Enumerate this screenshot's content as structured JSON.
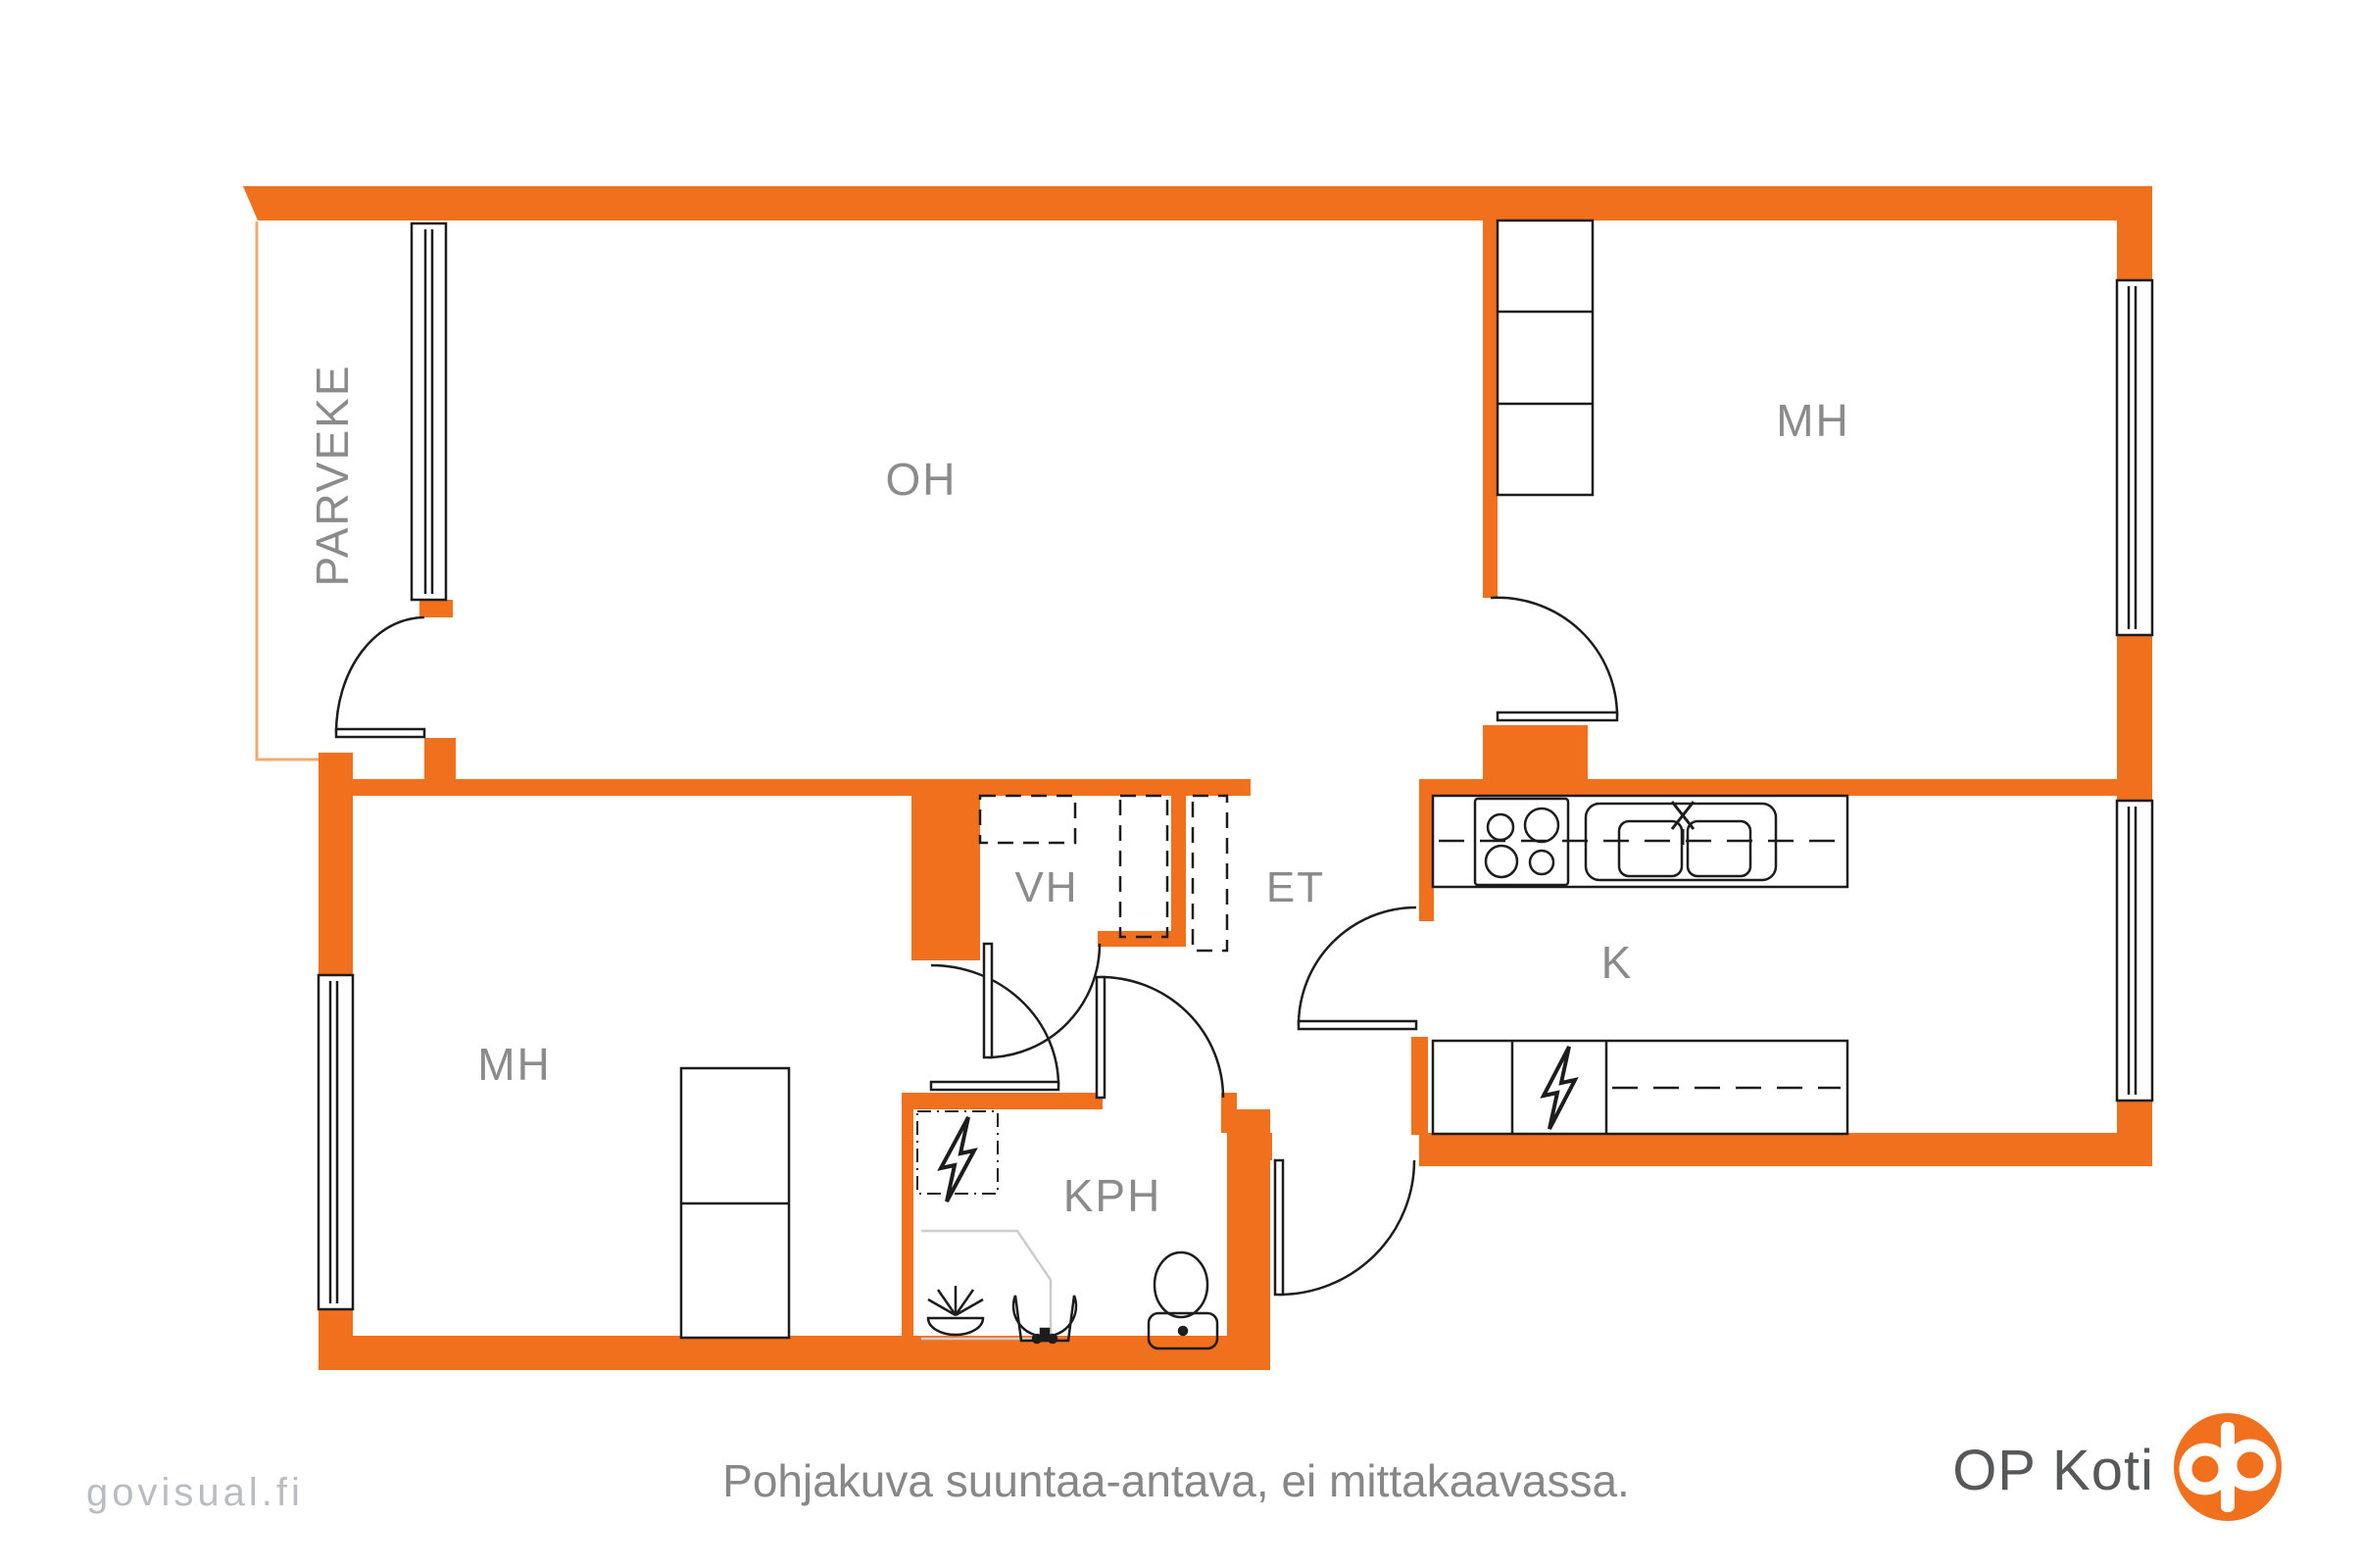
{
  "title": "Apartment floor plan",
  "rooms": [
    {
      "id": "parveke",
      "label": "PARVEKE"
    },
    {
      "id": "oh",
      "label": "OH"
    },
    {
      "id": "mh_top",
      "label": "MH"
    },
    {
      "id": "vh",
      "label": "VH"
    },
    {
      "id": "et",
      "label": "ET"
    },
    {
      "id": "k",
      "label": "K"
    },
    {
      "id": "mh_bottom",
      "label": "MH"
    },
    {
      "id": "kph",
      "label": "KPH"
    }
  ],
  "fixtures": [
    {
      "name": "stove-icon"
    },
    {
      "name": "double-sink-icon"
    },
    {
      "name": "faucet-icon"
    },
    {
      "name": "lightning-icon-kitchen"
    },
    {
      "name": "lightning-icon-bathroom"
    },
    {
      "name": "shower-icon"
    },
    {
      "name": "washbasin-icon"
    },
    {
      "name": "toilet-icon"
    },
    {
      "name": "wardrobe-mh-top"
    },
    {
      "name": "wardrobe-mh-bottom"
    },
    {
      "name": "wardrobe-dashed-vh-et"
    }
  ],
  "footer": {
    "watermark": "govisual.fi",
    "disclaimer": "Pohjakuva suuntaa-antava, ei mittakaavassa.",
    "brand": "OP Koti"
  },
  "colors": {
    "wall_orange": "#f1701e",
    "balcony_outline": "#f0aa70",
    "line_black": "#1c1c1c",
    "label_gray": "#8b8b8b",
    "shower_gray": "#cccccc",
    "disclaimer_gray": "#878787",
    "watermark_gray": "#b9bdc1",
    "brand_text_gray": "#57585a",
    "logo_orange": "#f1701e"
  }
}
